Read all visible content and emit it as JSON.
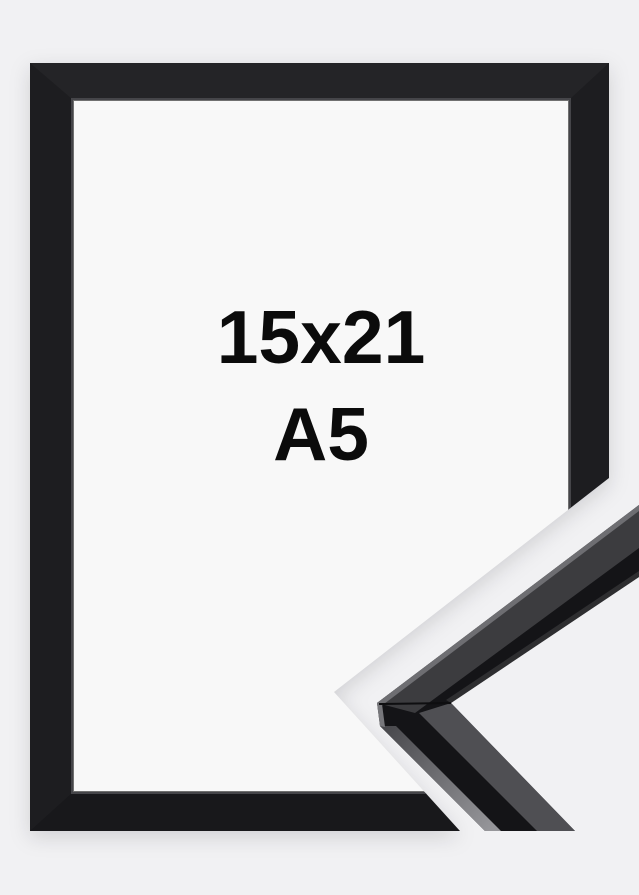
{
  "product_image": {
    "size_cm": "15x21",
    "size_format": "A5"
  },
  "colors": {
    "background": "#f1f1f3",
    "interior": "#f8f8f8",
    "frame_top": "#242427",
    "frame_side": "#1d1d20",
    "frame_bottom": "#18181b",
    "frame_lip": "#454549",
    "label_text": "#0b0b0b",
    "detail_dark": "#141417",
    "detail_face_upper": "#3c3c3f",
    "detail_face_lower": "#4f4f53",
    "detail_highlight": "#96969a"
  }
}
